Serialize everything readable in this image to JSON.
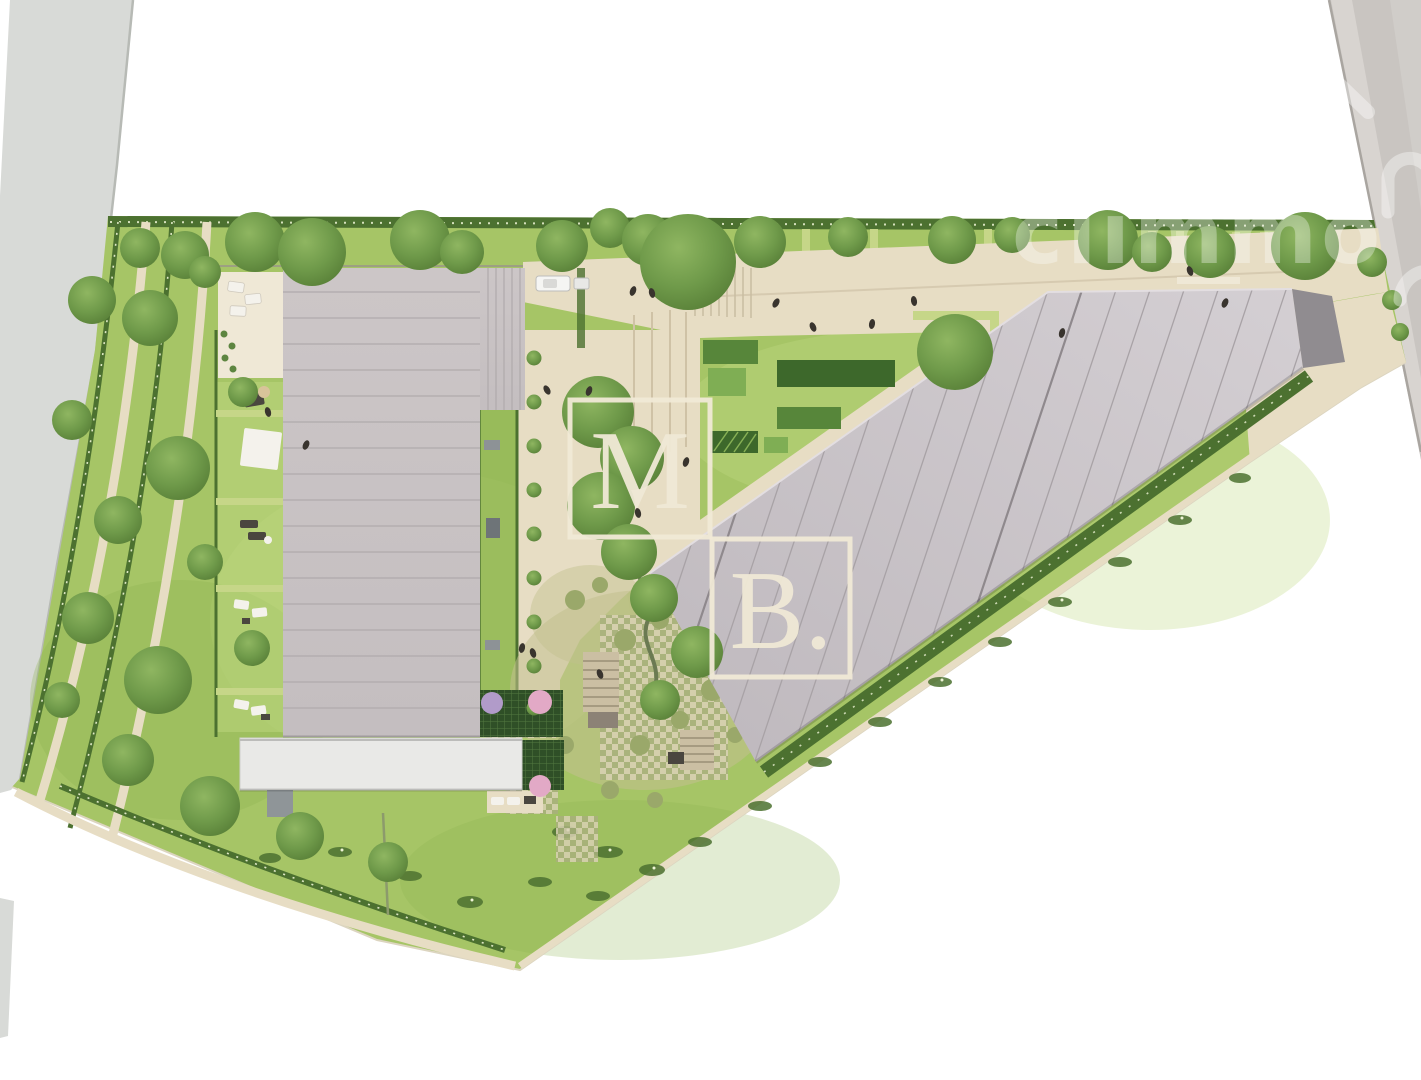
{
  "watermark": {
    "box1_letter": "M",
    "box2_letter": "B.",
    "brand_text": "climmo"
  },
  "palette": {
    "bg": "#ffffff",
    "road_left": "#d8dad7",
    "road_right": "#c9c5c1",
    "road_right_light": "#d6d2ce",
    "curb": "#a9a5a0",
    "sidewalk": "#d8d4d0",
    "grass": "#a6c566",
    "grass_light": "#bdd77f",
    "grass_dark": "#8cb251",
    "hedge": "#4c7130",
    "hedge_flower": "#c6d688",
    "speckle": "#eef4d6",
    "pavement": "#e7ddc4",
    "pavement_light": "#efe8d6",
    "pavement_edge": "#b9ab8e",
    "roof_a": "#c9c3c4",
    "roof_a_seam": "#b0aaac",
    "roof_b": "#c8c2c7",
    "roof_b_seam": "#a8a2a6",
    "roof_b_dark": "#908c90",
    "annex": "#e9e9e7",
    "trellis": "#2f4f27",
    "trellis_line": "#537941",
    "paver": "#d9d1b4",
    "paver_joint": "#a8b07c",
    "planting": "#c2c08f",
    "shrub": "#9aa86a",
    "tree": "#6f9a4a",
    "tree_dark": "#567d36",
    "tree_light": "#8fb661",
    "pink_tree": "#e2a9c6",
    "lilac_tree": "#b19bc9",
    "bed_dark": "#3d682b",
    "bed_mid": "#57863a",
    "bed_light": "#7fae54",
    "people": "#39342e",
    "furniture_white": "#f4f2ec",
    "furniture_dark": "#4a463f",
    "watermark_box": "#f0e9d6",
    "watermark_brand": "#ffffff"
  }
}
